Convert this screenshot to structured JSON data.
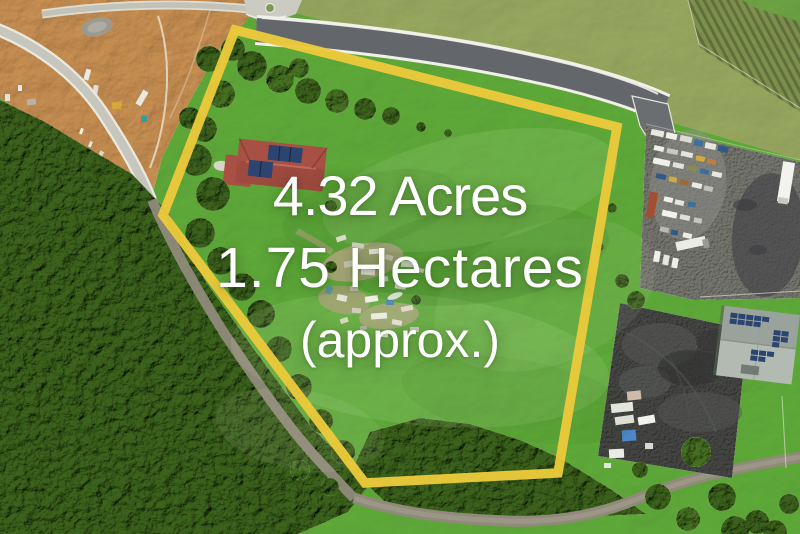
{
  "overlay": {
    "line1": "4.32 Acres",
    "line2": "1.75 Hectares",
    "line3": "(approx.)"
  },
  "colors": {
    "boundary": "#eac93b",
    "overlay-text": "#ffffff",
    "field": "#65ae46",
    "scrub": "#a0ab72",
    "forest": "#47682f",
    "dirt": "#c99a66",
    "road": "#63666b",
    "bush-road": "#908a7b",
    "gravel": "#7d7d78",
    "asphalt": "#4a4b4a",
    "house-roof": "#a85043",
    "solar-panel": "#2b4470"
  }
}
